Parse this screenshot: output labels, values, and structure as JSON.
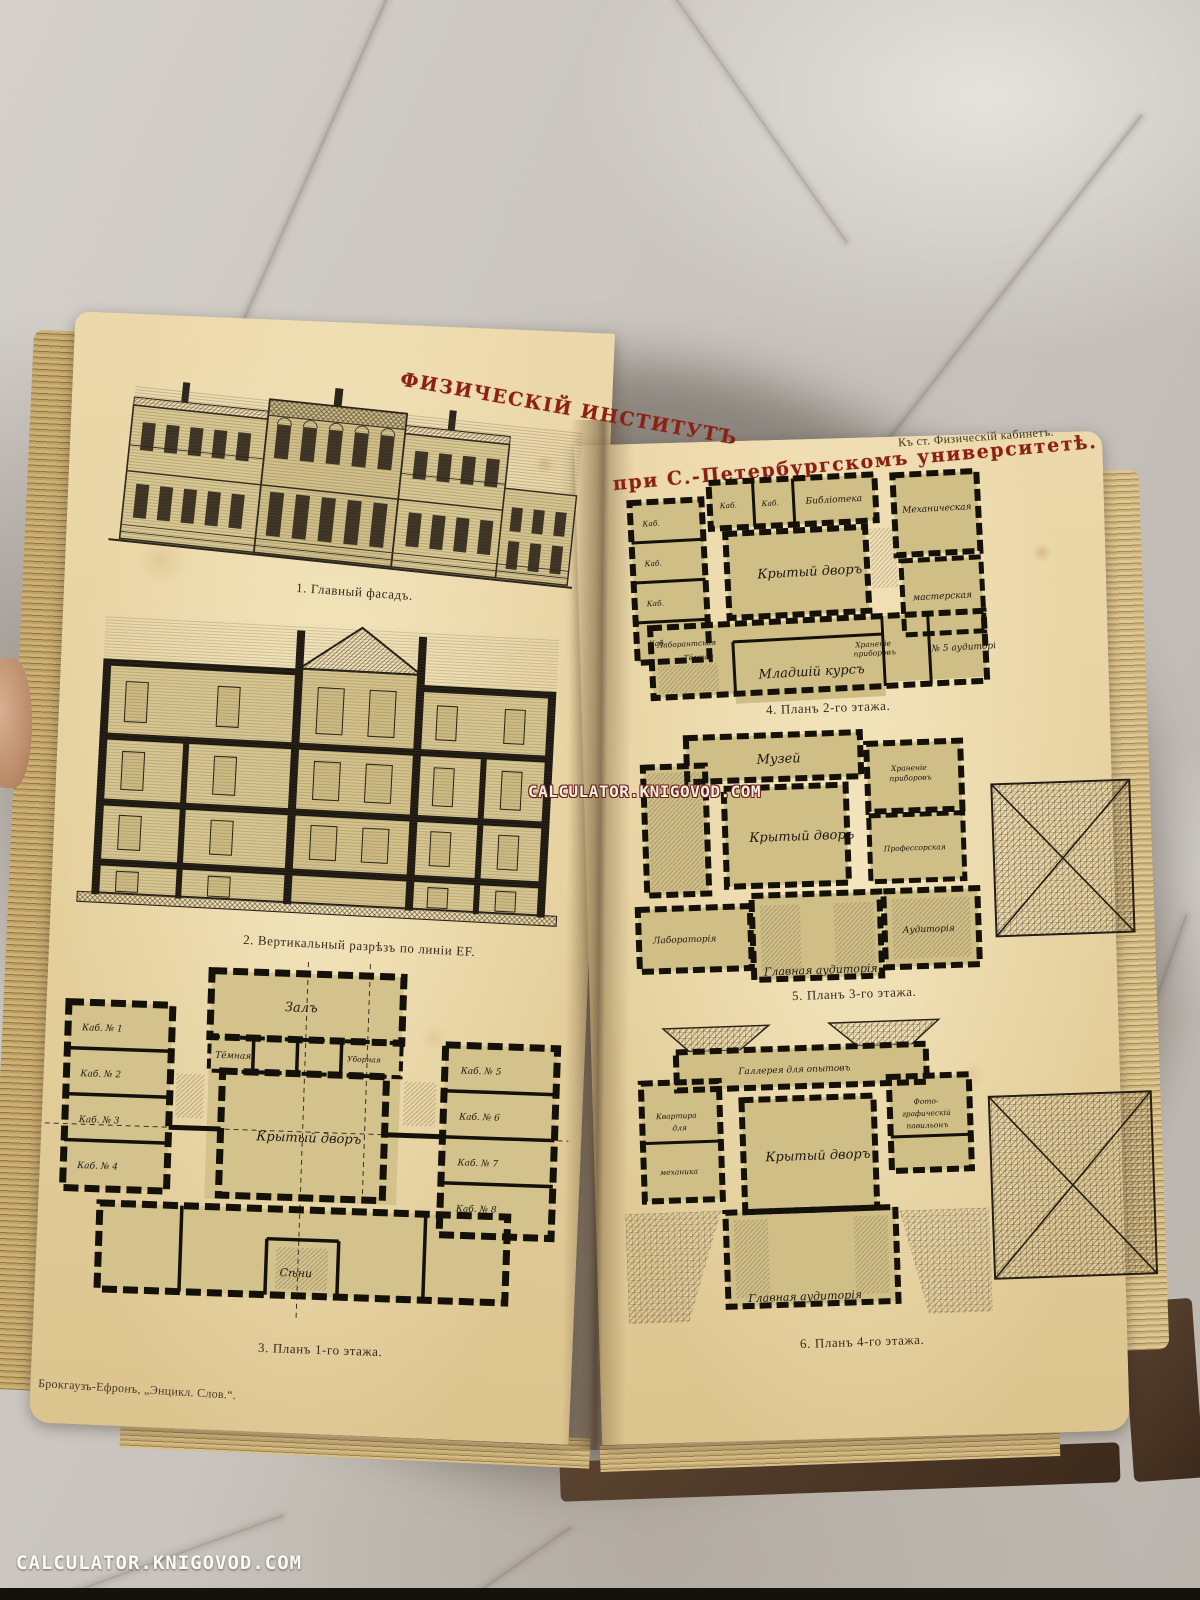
{
  "watermarks": {
    "center": "CALCULATOR.KNIGOVOD.COM",
    "corner": "CALCULATOR.KNIGOVOD.COM"
  },
  "book": {
    "title_left": "ФИЗИЧЕСКІЙ ИНСТИТУТЪ",
    "title_right": "при С.-Петербургскомъ университетѣ.",
    "header_note": "Къ ст. Физическій кабинетъ.",
    "imprint": "Брокгаузъ-Ефронъ, „Энцикл. Слов.“.",
    "title_color": "#8c2015"
  },
  "figures": {
    "fig1": {
      "caption": "1. Главный фасадъ."
    },
    "fig2": {
      "caption": "2. Вертикальный разрѣзъ по линіи EF."
    },
    "fig3": {
      "caption": "3. Планъ 1-го этажа.",
      "labels": {
        "hall": "Залъ",
        "courtyard": "Крытый дворъ",
        "entry": "Сѣни",
        "dark": "Тёмная",
        "wc": "Уборная",
        "rooms_left": [
          "Каб. № 1",
          "Каб. № 2",
          "Каб. № 3",
          "Каб. № 4"
        ],
        "rooms_right": [
          "Каб. № 5",
          "Каб. № 6",
          "Каб. № 7",
          "Каб. № 8"
        ]
      }
    },
    "fig4": {
      "caption": "4. Планъ 2-го этажа.",
      "labels": {
        "courtyard": "Крытый дворъ",
        "course": "Младшій курсъ",
        "library": "Библіотека",
        "cab": "Каб.",
        "auditorium": "№ 5 аудиторія",
        "storage_1": "Храненіе",
        "storage_2": "приборовъ",
        "mechanical": "Механическая",
        "workshop": "мастерская",
        "assistant": "Лаборантская",
        "dark": "Тёмная"
      }
    },
    "fig5": {
      "caption": "5. Планъ 3-го этажа.",
      "labels": {
        "museum": "Музей",
        "courtyard": "Крытый дворъ",
        "laboratory": "Лабораторія",
        "main_aud": "Главная аудиторія",
        "auditorium": "Аудиторія",
        "prof": "Профессорская",
        "storage_1": "Храненіе",
        "storage_2": "приборовъ"
      }
    },
    "fig6": {
      "caption": "6. Планъ 4-го этажа.",
      "labels": {
        "gallery": "Галлерея для опытовъ",
        "courtyard": "Крытый дворъ",
        "main_aud": "Главная аудиторія",
        "photo_1": "Фото-",
        "photo_2": "графическій",
        "photo_3": "павильонъ",
        "apt_1": "Квартира",
        "apt_2": "для",
        "apt_3": "механика"
      }
    }
  }
}
